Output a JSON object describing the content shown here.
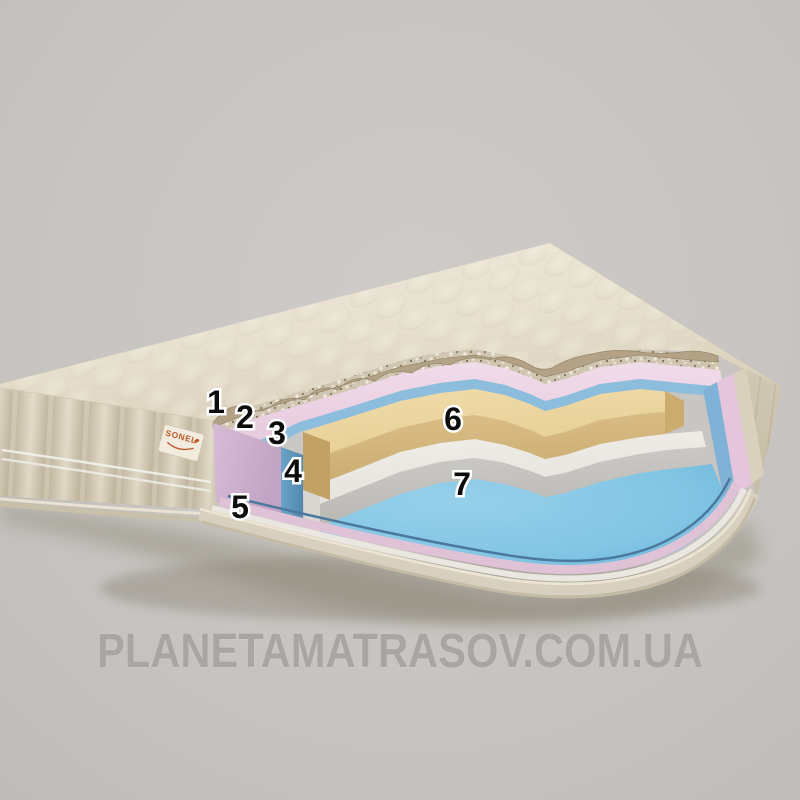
{
  "scene": {
    "background_color": "#c8c5c2",
    "subject": "mattress-layers-cutaway-render"
  },
  "brand_tag": {
    "label": "SONEL",
    "text_color": "#bf5a2d",
    "fabric_color": "#f2ecdf"
  },
  "watermark": {
    "text": "PLANETAMATRASOV.COM.UA",
    "color": "#a8a5a1"
  },
  "annotations": {
    "style": {
      "text_color": "#0c0c0c",
      "outline_color": "#ffffff"
    },
    "labels": [
      {
        "number": "1",
        "x": 216,
        "y": 402,
        "layer": "quilted-cover",
        "color": "#e9e2d2"
      },
      {
        "number": "2",
        "x": 245,
        "y": 417,
        "layer": "batting-wadding",
        "color": "#d3c9b5"
      },
      {
        "number": "3",
        "x": 277,
        "y": 433,
        "layer": "pink-foam",
        "color": "#eed8e8"
      },
      {
        "number": "4",
        "x": 293,
        "y": 471,
        "layer": "blue-foam",
        "color": "#6ba3c9"
      },
      {
        "number": "5",
        "x": 240,
        "y": 507,
        "layer": "bottom-cover",
        "color": "#d8d0be"
      },
      {
        "number": "6",
        "x": 453,
        "y": 419,
        "layer": "tan-foam",
        "color": "#ead7a3"
      },
      {
        "number": "7",
        "x": 462,
        "y": 484,
        "layer": "white-foam",
        "color": "#eceae5"
      }
    ]
  },
  "palette": {
    "cover_cream_light": "#eee8d8",
    "cover_cream_shadow": "#dcd3be",
    "side_fabric": "#d5cdb9",
    "batting_speckle": "#cfc5b1",
    "batting_flap": "#b3a285",
    "pink_band": "#eed8e8",
    "pink_cut_face": "#cdb2cf",
    "blue_layer": "#7fb2d6",
    "tan_foam_top": "#eed9a6",
    "tan_foam_front": "#d5b87e",
    "white_foam_top": "#efede8",
    "white_foam_front": "#c6c4c0",
    "bottom_blue": "#82c5e4",
    "pink_rim": "#e0c2d7",
    "cream_rim": "#d8d0be",
    "floor_gray": "#c4c1be"
  }
}
